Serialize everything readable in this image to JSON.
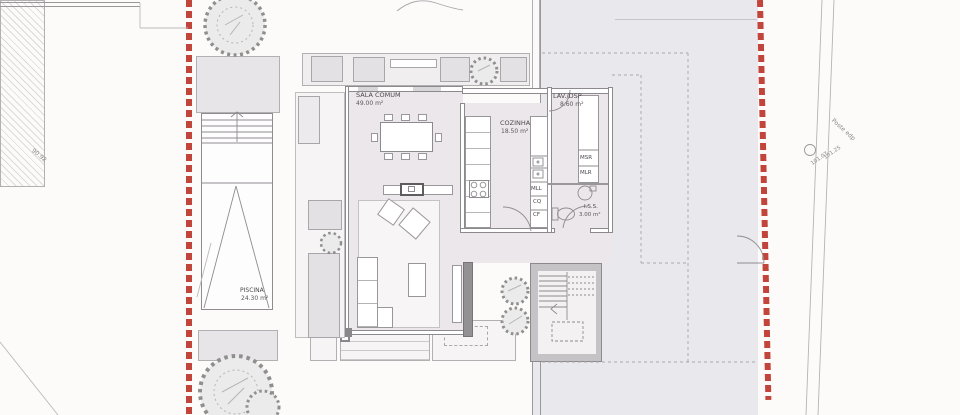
{
  "site": {
    "boundary_color": "#c2453c",
    "left_boundary_dimension": "90.92",
    "road": {
      "pole_label": "Poste edp",
      "elevation_upper": "101.25",
      "elevation_lower": "101.07"
    }
  },
  "rooms": {
    "living": {
      "name": "SALA COMUM",
      "area": "49.00 m²"
    },
    "kitchen": {
      "name": "COZINHA",
      "area": "18.50 m²"
    },
    "laundry": {
      "name": "LAV./DSP",
      "area": "8.60 m²"
    },
    "wc": {
      "name": "I.S.S.",
      "area": "3.00 m²"
    },
    "pool": {
      "name": "PISCINA",
      "area": "24.30 m²"
    }
  },
  "appliances": {
    "msr": "MSR",
    "mlr": "MLR",
    "mll": "MLL",
    "cq": "CQ",
    "cf": "CF"
  },
  "colors": {
    "boundary_red": "#c2453c",
    "interior_floor": "#ece7ea",
    "paved_area": "#e9e9ed",
    "deck": "#e7e5e7"
  }
}
